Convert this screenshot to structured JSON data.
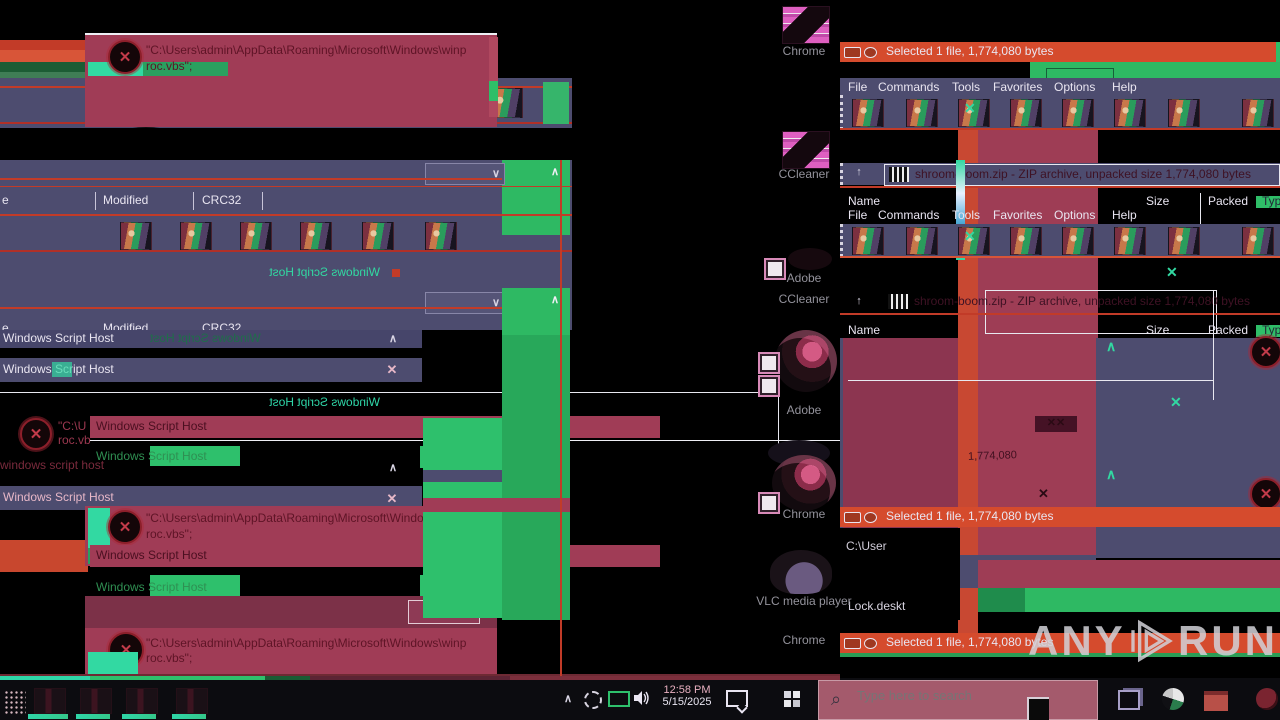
{
  "wsh": {
    "title": "Windows Script Host",
    "title_lower": "windows script host",
    "path_line1": "\"C:\\Users\\admin\\AppData\\Roaming\\Microsoft\\Windows\\winp",
    "path_line2": "roc.vbs\";",
    "path_frag_a": "\"C:\\U",
    "path_frag_b": "roc.vb",
    "ok": "OK"
  },
  "winrar": {
    "menu": [
      "File",
      "Commands",
      "Tools",
      "Favorites",
      "Options",
      "Help"
    ],
    "address_text": "shroom-boom.zip - ZIP archive, unpacked size 1,774,080 bytes",
    "status_text": "Selected 1 file, 1,774,080 bytes",
    "col_name": "Name",
    "col_size": "Size",
    "col_packed": "Packed",
    "col_type": "Typ",
    "col_modified": "Modified",
    "col_crc": "CRC32",
    "col_name_frag": "e",
    "size_fragment": "1,774,080"
  },
  "desktop": {
    "icon_labels": [
      "Chrome",
      "CCleaner",
      "Adobe",
      "CCleaner",
      "Adobe",
      "Chrome",
      "VLC media player",
      "Chrome"
    ],
    "lock_label": "Lock.deskt",
    "path_fragment": "C:\\User"
  },
  "taskbar": {
    "search_placeholder": "Type here to search",
    "clock_time": "12:58 PM",
    "clock_date": "5/15/2025"
  },
  "watermark": {
    "word1": "ANY",
    "word2": "RUN"
  },
  "icons": {
    "close": "✕",
    "error": "✕",
    "chevron_up": "∧",
    "chevron_down": "∨",
    "up_arrow": "↑",
    "magnifier": "⌕"
  }
}
